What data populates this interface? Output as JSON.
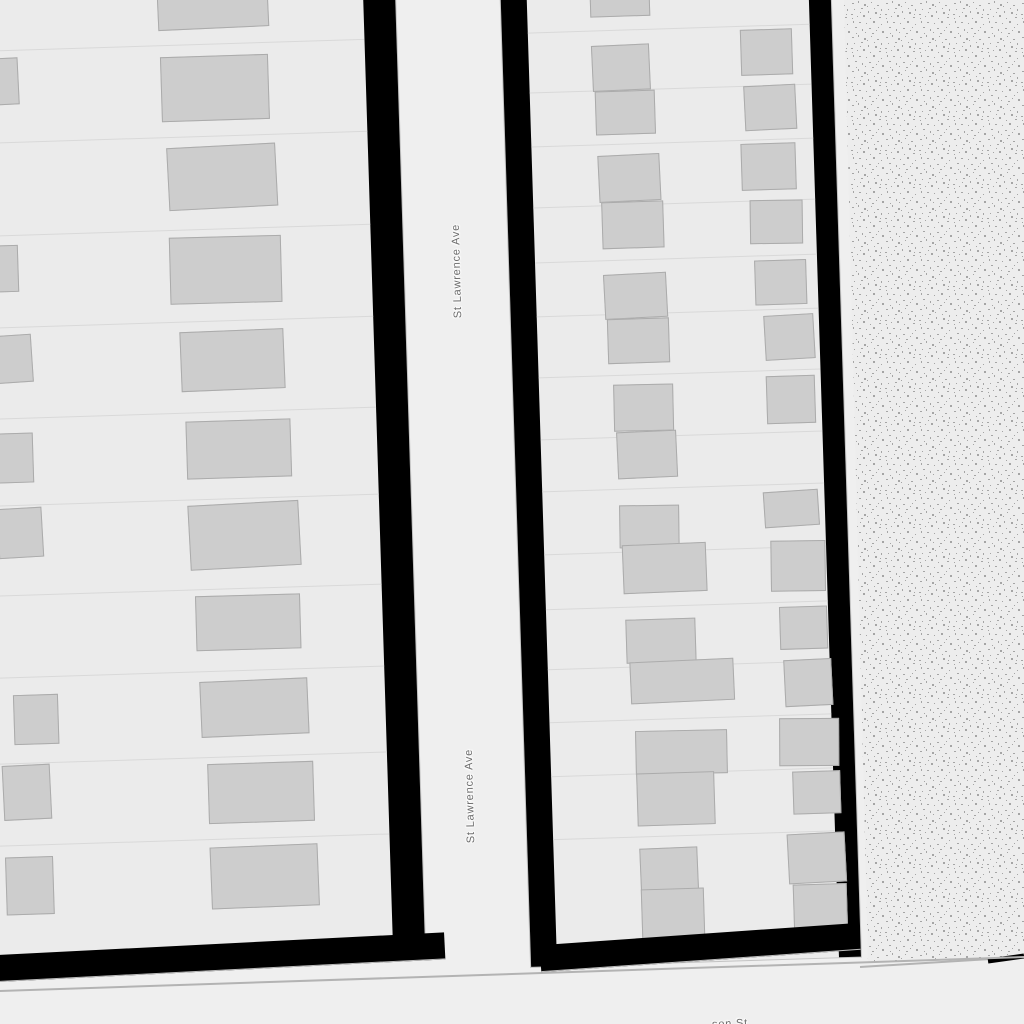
{
  "map": {
    "streets": {
      "vertical_street_name": "St Lawrence Ave",
      "bottom_street_partial": "son St"
    },
    "colors": {
      "street": "#efefef",
      "parcel": "#ebebeb",
      "building": "#cdcdcd",
      "building-border": "#ababab",
      "parcel-line": "#d9d9d9",
      "casing": "#000000",
      "label": "#6b6b6b",
      "texture-bg": "#ededed",
      "texture-dot": "#a5a5a5",
      "edge-line": "#b3b3b3"
    },
    "left_block": {
      "parcel_lines": [
        125,
        217,
        310,
        402,
        493,
        580,
        670,
        752,
        838,
        920
      ],
      "buildings": [
        [
          231,
          74,
          111,
          36,
          -0.8
        ],
        [
          232,
          137,
          108,
          65,
          0
        ],
        [
          236,
          227,
          109,
          63,
          -1.2
        ],
        [
          235,
          318,
          112,
          67,
          0.3
        ],
        [
          243,
          412,
          104,
          60,
          -0.5
        ],
        [
          246,
          502,
          105,
          58,
          0
        ],
        [
          246,
          585,
          111,
          65,
          -1.3
        ],
        [
          250,
          677,
          105,
          55,
          0.2
        ],
        [
          252,
          762,
          108,
          56,
          -0.7
        ],
        [
          257,
          845,
          106,
          60,
          0
        ],
        [
          257,
          928,
          108,
          62,
          -0.5
        ],
        [
          40,
          133,
          50,
          47,
          -1
        ],
        [
          38,
          320,
          46,
          47,
          0
        ],
        [
          50,
          410,
          45,
          48,
          -2
        ],
        [
          48,
          508,
          45,
          50,
          0
        ],
        [
          55,
          583,
          45,
          50,
          -1.5
        ],
        [
          65,
          770,
          45,
          50,
          0
        ],
        [
          52,
          840,
          48,
          55,
          -1
        ],
        [
          52,
          932,
          48,
          58,
          0
        ]
      ]
    },
    "right_block": {
      "parcel_lines": [
        88,
        148,
        202,
        263,
        318,
        372,
        433,
        495,
        547,
        610,
        665,
        725,
        778,
        832,
        895
      ],
      "buildings": [
        [
          63,
          40,
          60,
          35,
          0
        ],
        [
          63,
          103,
          58,
          46,
          -0.8
        ],
        [
          65,
          149,
          60,
          44,
          0
        ],
        [
          66,
          213,
          62,
          47,
          -1
        ],
        [
          68,
          260,
          62,
          47,
          0
        ],
        [
          68,
          332,
          63,
          45,
          -1.2
        ],
        [
          70,
          377,
          62,
          45,
          0
        ],
        [
          74,
          443,
          60,
          47,
          0.5
        ],
        [
          76,
          490,
          60,
          47,
          -0.8
        ],
        [
          76,
          564,
          60,
          43,
          1
        ],
        [
          78,
          603,
          84,
          49,
          -0.5
        ],
        [
          79,
          678,
          70,
          44,
          0
        ],
        [
          82,
          720,
          104,
          42,
          -0.8
        ],
        [
          85,
          790,
          92,
          44,
          0.6
        ],
        [
          85,
          832,
          78,
          53,
          0
        ],
        [
          86,
          907,
          58,
          43,
          -0.6
        ],
        [
          86,
          948,
          63,
          50,
          0
        ],
        [
          212,
          92,
          52,
          46,
          0
        ],
        [
          214,
          148,
          52,
          45,
          -1
        ],
        [
          209,
          206,
          55,
          47,
          0
        ],
        [
          216,
          263,
          53,
          44,
          1
        ],
        [
          219,
          323,
          52,
          45,
          0
        ],
        [
          227,
          378,
          50,
          45,
          -1.5
        ],
        [
          227,
          439,
          49,
          48,
          0
        ],
        [
          221,
          554,
          55,
          36,
          -2
        ],
        [
          226,
          604,
          55,
          51,
          1
        ],
        [
          233,
          670,
          48,
          43,
          0
        ],
        [
          236,
          723,
          48,
          47,
          -1
        ],
        [
          229,
          782,
          60,
          48,
          1.5
        ],
        [
          241,
          835,
          48,
          43,
          0
        ],
        [
          234,
          897,
          58,
          50,
          -1.2
        ],
        [
          238,
          948,
          54,
          57,
          0
        ]
      ]
    }
  }
}
